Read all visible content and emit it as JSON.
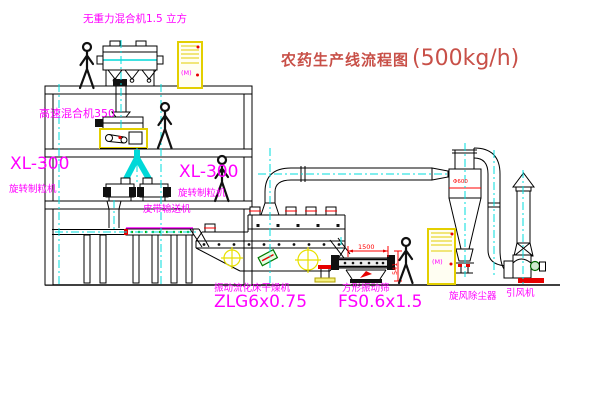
{
  "title": {
    "text": "农药生产线流程图",
    "capacity": "(500kg/h)"
  },
  "equipment": {
    "gravity_mixer": {
      "label": "无重力混合机1.5 立方"
    },
    "high_speed_mixer": {
      "label": "高速混合机350"
    },
    "granulator_left": {
      "model": "XL-300",
      "name": "旋转制粒机"
    },
    "granulator_right": {
      "model": "XL-300",
      "name": "旋转制粒机"
    },
    "belt_conveyor": {
      "label": "皮带输送机"
    },
    "fluid_bed_dryer": {
      "name": "振动流化床干燥机",
      "model": "ZLG6x0.75"
    },
    "vibrating_screen": {
      "name": "方形振动筛",
      "model": "FS0.6x1.5",
      "dim_length": "1500",
      "dim_height": "541"
    },
    "cyclone": {
      "label": "旋风除尘器",
      "tag": "Φ600"
    },
    "induced_draft_fan": {
      "label": "引风机"
    },
    "control_cabinet": {
      "symbol": "(M)"
    }
  },
  "colors": {
    "label_magenta": "#ff00ff",
    "title_red": "#c85048",
    "centerline_cyan": "#00dede",
    "cabinet_yellow": "#e3cf00",
    "dimension_red": "#ff0000",
    "line_black": "#000000",
    "accent_green": "#00b000"
  }
}
